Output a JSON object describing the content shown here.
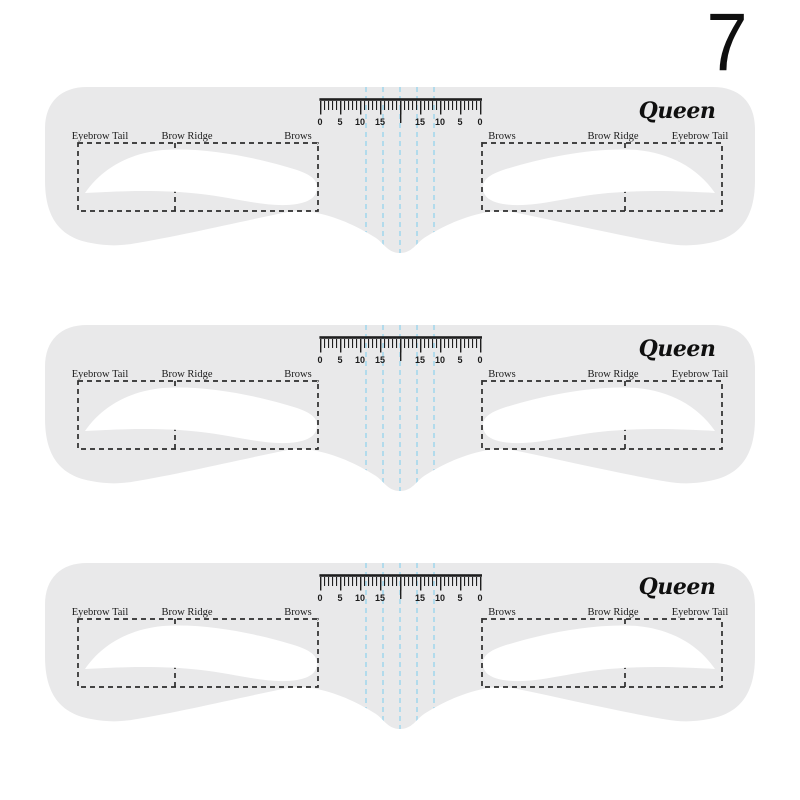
{
  "page": {
    "background_color": "#ffffff",
    "variant_number": "7"
  },
  "stencil": {
    "brand": "Queen",
    "count": 3,
    "body_color": "#e9e9ea",
    "cutout_color": "#ffffff",
    "outline_color": "#2d2d2d",
    "ink_color": "#1f1f1f",
    "guide_line_color": "#9ad5ee",
    "labels": {
      "left": [
        "Eyebrow Tail",
        "Brow Ridge",
        "Brows"
      ],
      "right": [
        "Brows",
        "Brow Ridge",
        "Eyebrow Tail"
      ],
      "corner_mark": ","
    },
    "ruler": {
      "numbers": [
        "0",
        "5",
        "10",
        "15",
        "15",
        "10",
        "5",
        "0"
      ]
    }
  }
}
